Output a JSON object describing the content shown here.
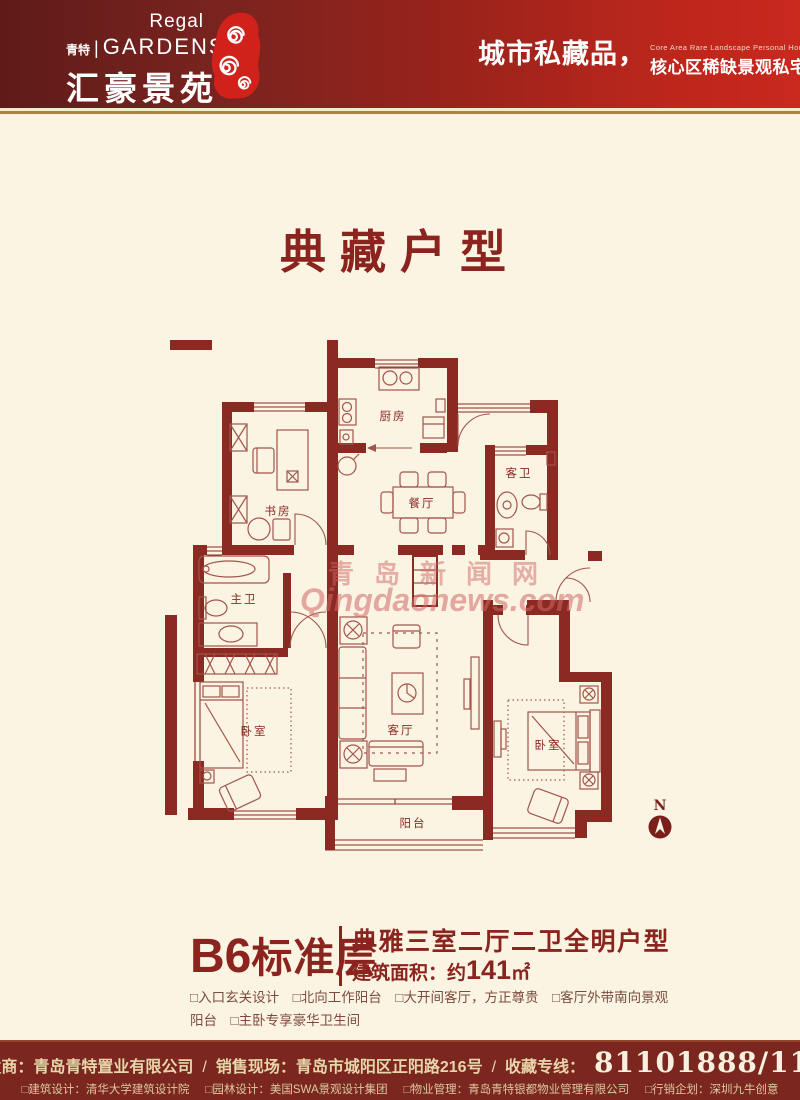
{
  "colors": {
    "accent": "#8b241e",
    "wall": "#8a2a22",
    "header_dark": "#5f1b18",
    "header_red": "#c9281d",
    "footer_bg": "#7c2620",
    "gold": "#aa8544",
    "cream": "#fbf4e3",
    "watermark": "#cf6767"
  },
  "header": {
    "logo_en_small": "Regal",
    "logo_cn_tag": "青特",
    "logo_divider": "|",
    "logo_en_large": "GARDENS",
    "logo_cn_large": "汇豪景苑",
    "tagline_main": "城市私藏品，",
    "tagline_en": "Core Area Rare Landscape Personal House",
    "tagline_sub": "核心区稀缺景观私宅"
  },
  "title": "典藏户型",
  "floorplan": {
    "rooms": [
      {
        "label": "厨房"
      },
      {
        "label": "书房"
      },
      {
        "label": "餐厅"
      },
      {
        "label": "客卫"
      },
      {
        "label": "主卫"
      },
      {
        "label": "卧室"
      },
      {
        "label": "客厅"
      },
      {
        "label": "卧室"
      },
      {
        "label": "阳台"
      }
    ],
    "north_label": "N",
    "watermark_cn": "青岛新闻网",
    "watermark_en": "Qingdaonews.com"
  },
  "unit": {
    "name_latin": "B6",
    "name_cn": "标准层",
    "headline": "典雅三室二厅二卫全明户型",
    "area_prefix": "建筑面积：约",
    "area_number": "141",
    "area_unit": "㎡",
    "features_line1": "□入口玄关设计　□北向工作阳台　□大开间客厅，方正尊贵　□客厅外带南向景观",
    "features_line2": "阳台　□主卧专享豪华卫生间"
  },
  "footer": {
    "developer": "开发商：青岛青特置业有限公司",
    "slash": "/",
    "sales": "销售现场：青岛市城阳区正阳路216号",
    "hotline_label": "收藏专线：",
    "hotline_number": "81101888/111",
    "credits": [
      "□建筑设计：清华大学建筑设计院",
      "□园林设计：美国SWA景观设计集团",
      "□物业管理：青岛青特银都物业管理有限公司",
      "□行销企划：深圳九牛创意"
    ]
  }
}
